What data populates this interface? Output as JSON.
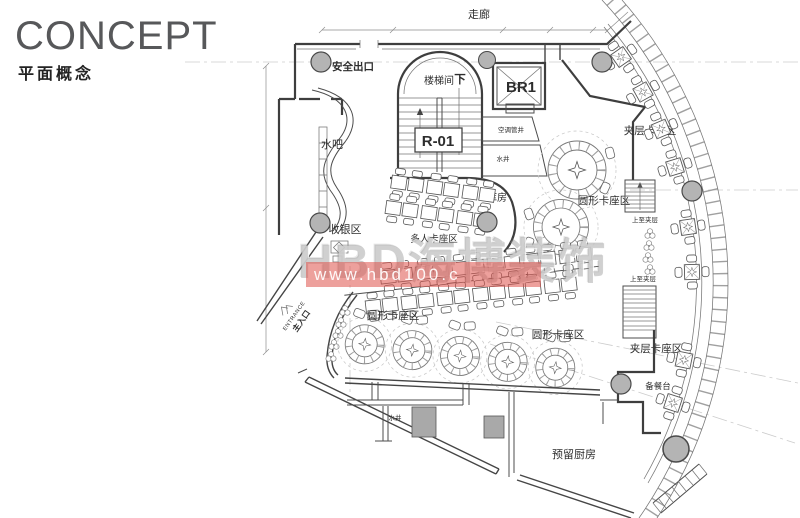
{
  "header": {
    "title": "CONCEPT",
    "subtitle": "平面概念"
  },
  "watermark": {
    "brand": "HBD海博装饰",
    "url": "www.hbd100.c",
    "bar_color": "#de524a"
  },
  "plan": {
    "colors": {
      "wall_line": "#3e3e3e",
      "column_fill": "#b4b4b4",
      "shaft_fill": "#a9a9a9",
      "centerline": "#cccccc"
    },
    "labels": {
      "corridor": "走廊",
      "safety_exit": "安全出口",
      "stair_room": "楼梯间",
      "down": "下",
      "br1": "BR1",
      "r01": "R-01",
      "hvac_shaft": "空调管井",
      "shaft_top": "水井",
      "water_bar": "水吧",
      "cashier": "收银区",
      "storage": "库房",
      "multi_booth": "多人卡座区",
      "round_booth_mid": "圆形卡座区",
      "round_booth_left": "圆形卡座区",
      "round_booth_right": "圆形卡座区",
      "mezz_booth_top": "夹层卡座区",
      "mezz_booth_btm": "夹层卡座区",
      "up_mezz_a": "上至夹层",
      "up_mezz_b": "上至夹层",
      "prep_counter": "备餐台",
      "shaft_btm": "水井",
      "kitchen": "预留厨房",
      "entrance_en": "ENTRANCE",
      "entrance_cn": "主入口"
    }
  }
}
